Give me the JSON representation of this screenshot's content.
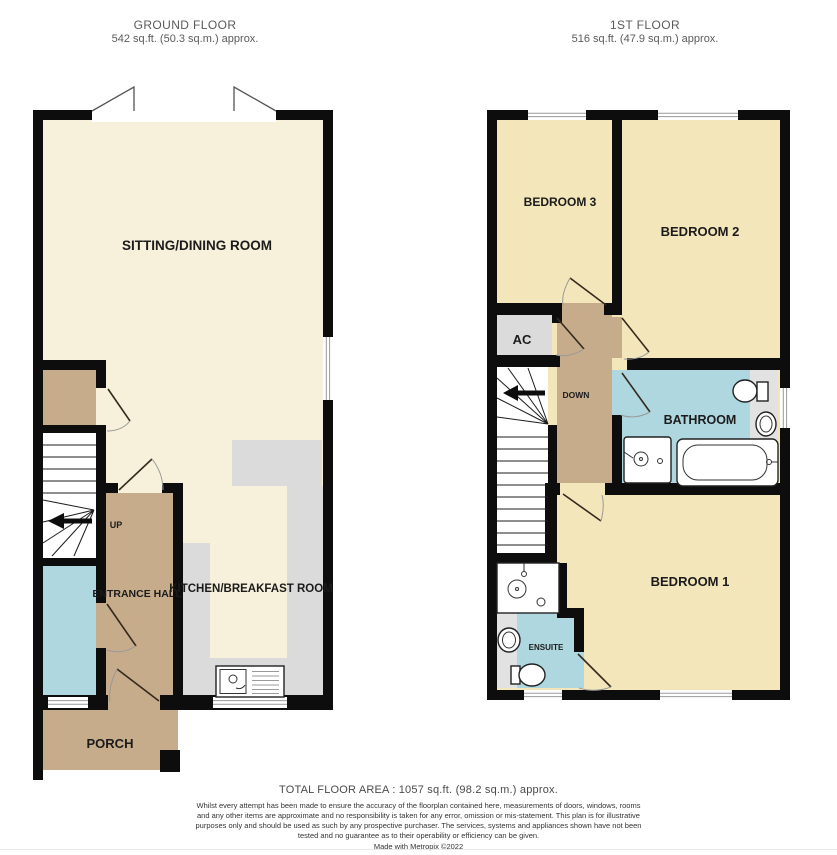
{
  "header": {
    "ground_floor": {
      "title": "GROUND FLOOR",
      "area": "542 sq.ft. (50.3 sq.m.) approx."
    },
    "first_floor": {
      "title": "1ST FLOOR",
      "area": "516 sq.ft. (47.9 sq.m.) approx."
    }
  },
  "ground_floor": {
    "rooms": {
      "sitting_dining": "SITTING/DINING ROOM",
      "kitchen": "KITCHEN/BREAKFAST ROOM",
      "entrance_hall": "ENTRANCE HALL",
      "porch": "PORCH"
    },
    "stairs_label": "UP"
  },
  "first_floor": {
    "rooms": {
      "bedroom1": "BEDROOM 1",
      "bedroom2": "BEDROOM 2",
      "bedroom3": "BEDROOM 3",
      "bathroom": "BATHROOM",
      "ensuite": "ENSUITE",
      "airing_cupboard": "AC"
    },
    "stairs_label": "DOWN"
  },
  "footer": {
    "total_area": "TOTAL FLOOR AREA : 1057 sq.ft. (98.2 sq.m.) approx.",
    "disclaimer": "Whilst every attempt has been made to ensure the accuracy of the floorplan contained here, measurements of doors, windows, rooms and any other items are approximate and no responsibility is taken for any error, omission or mis-statement. This plan is for illustrative purposes only and should be used as such by any prospective purchaser. The services, systems and appliances shown have not been tested and no guarantee as to their operability or efficiency can be given.",
    "credit": "Made with Metropix ©2022"
  },
  "colors": {
    "wall": "#0d0d0d",
    "cream": "#f7f0db",
    "yellow": "#f4e6bb",
    "tan": "#c7ac8c",
    "blue": "#afd7df",
    "gray": "#dbdbdb",
    "graylt": "#e2e2e2"
  }
}
